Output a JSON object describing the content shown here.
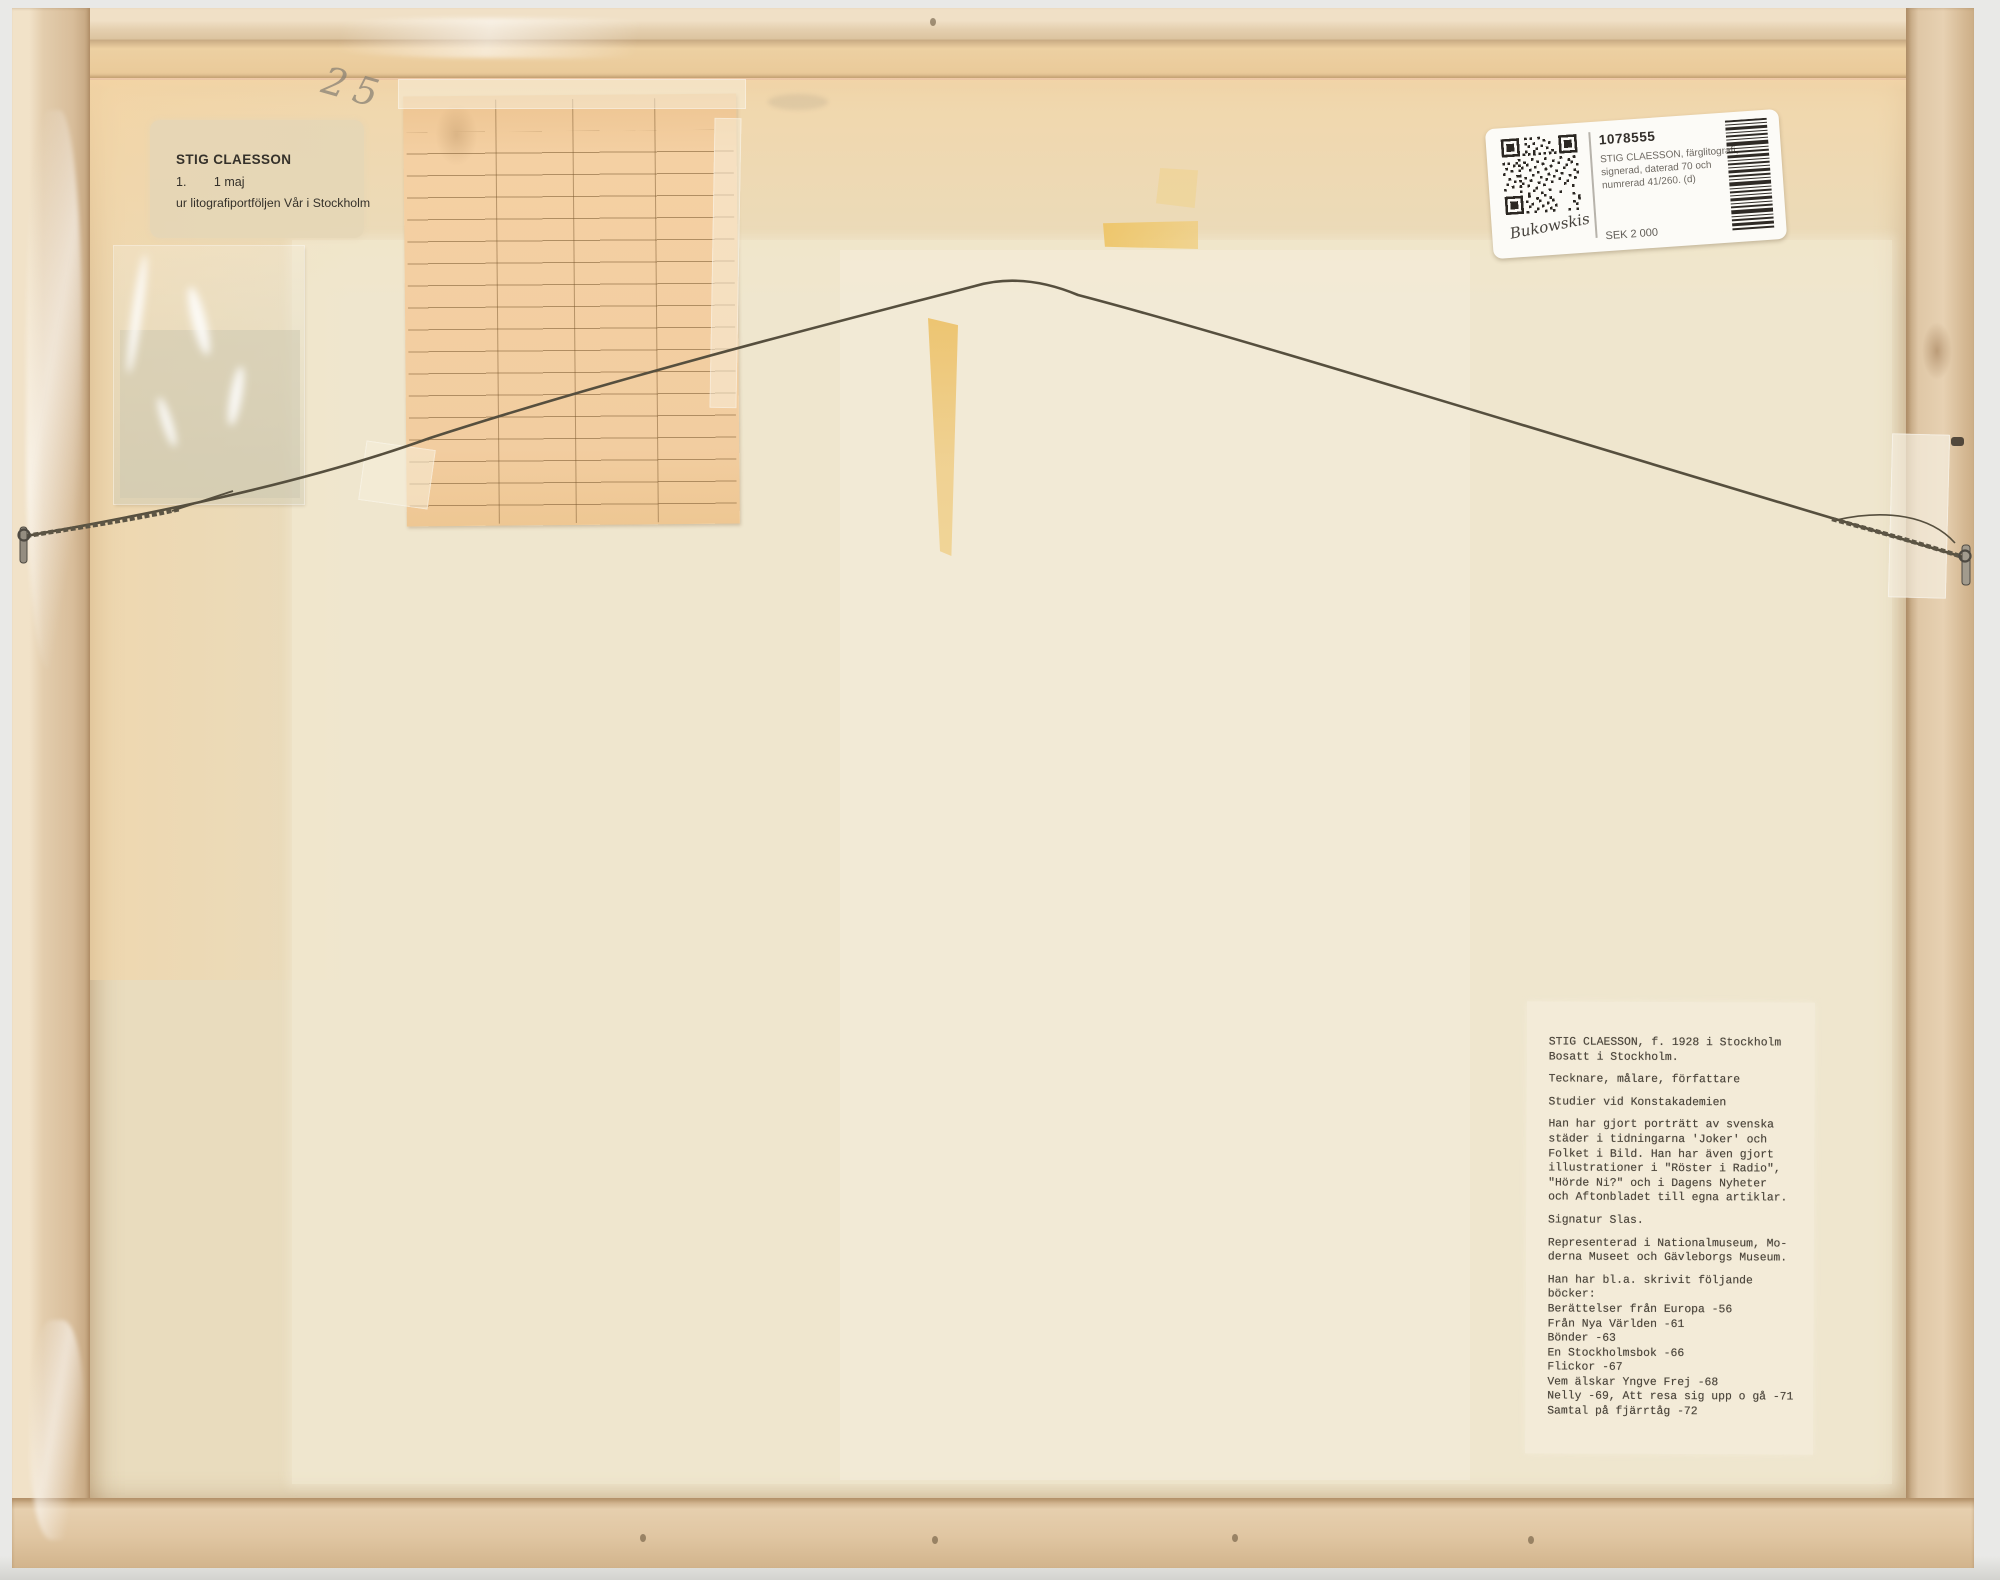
{
  "portfolio_label": {
    "artist": "STIG CLAESSON",
    "number": "1.",
    "title": "1 maj",
    "series": "ur litografiportföljen Vår i Stockholm"
  },
  "pencil_note": "25",
  "auction_label": {
    "lot_number": "1078555",
    "description": [
      "STIG CLAESSON, färglitografi,",
      "signerad, daterad 70 och",
      "numrerad 41/260. (d)"
    ],
    "estimate": "SEK 2 000",
    "auction_house": "Bukowskis",
    "qr_icon": "qr-code-icon",
    "barcode_icon": "barcode-icon"
  },
  "bio_label": {
    "paragraphs": [
      [
        "STIG CLAESSON, f. 1928 i Stockholm",
        "Bosatt i Stockholm."
      ],
      [
        "Tecknare, målare, författare"
      ],
      [
        "Studier vid Konstakademien"
      ],
      [
        "Han har gjort porträtt av svenska",
        "städer i tidningarna 'Joker' och",
        "Folket i Bild. Han har även gjort",
        "illustrationer i \"Röster i Radio\",",
        "\"Hörde Ni?\" och i Dagens Nyheter",
        "och Aftonbladet till egna artiklar."
      ],
      [
        "Signatur Slas."
      ],
      [
        "Representerad i Nationalmuseum, Mo-",
        "derna Museet och Gävleborgs Museum."
      ],
      [
        "Han har bl.a. skrivit följande",
        "böcker:",
        "Berättelser från Europa -56",
        "Från Nya Världen -61",
        "Bönder -63",
        "En Stockholmsbok -66",
        "Flickor -67",
        "Vem älskar Yngve Frej -68",
        "Nelly -69, Att resa sig upp o gå -71",
        "Samtal på fjärrtåg -72"
      ]
    ]
  },
  "colors": {
    "frame_wood": "#dfc7a6",
    "backing_board": "#e9dcbe",
    "grid_paper": "#f3cfa2",
    "tape_yellow": "#ecc264",
    "auction_label_white": "#fcfbf7",
    "bio_label_paper": "#f3ecd9",
    "wire": "#564f3e"
  }
}
